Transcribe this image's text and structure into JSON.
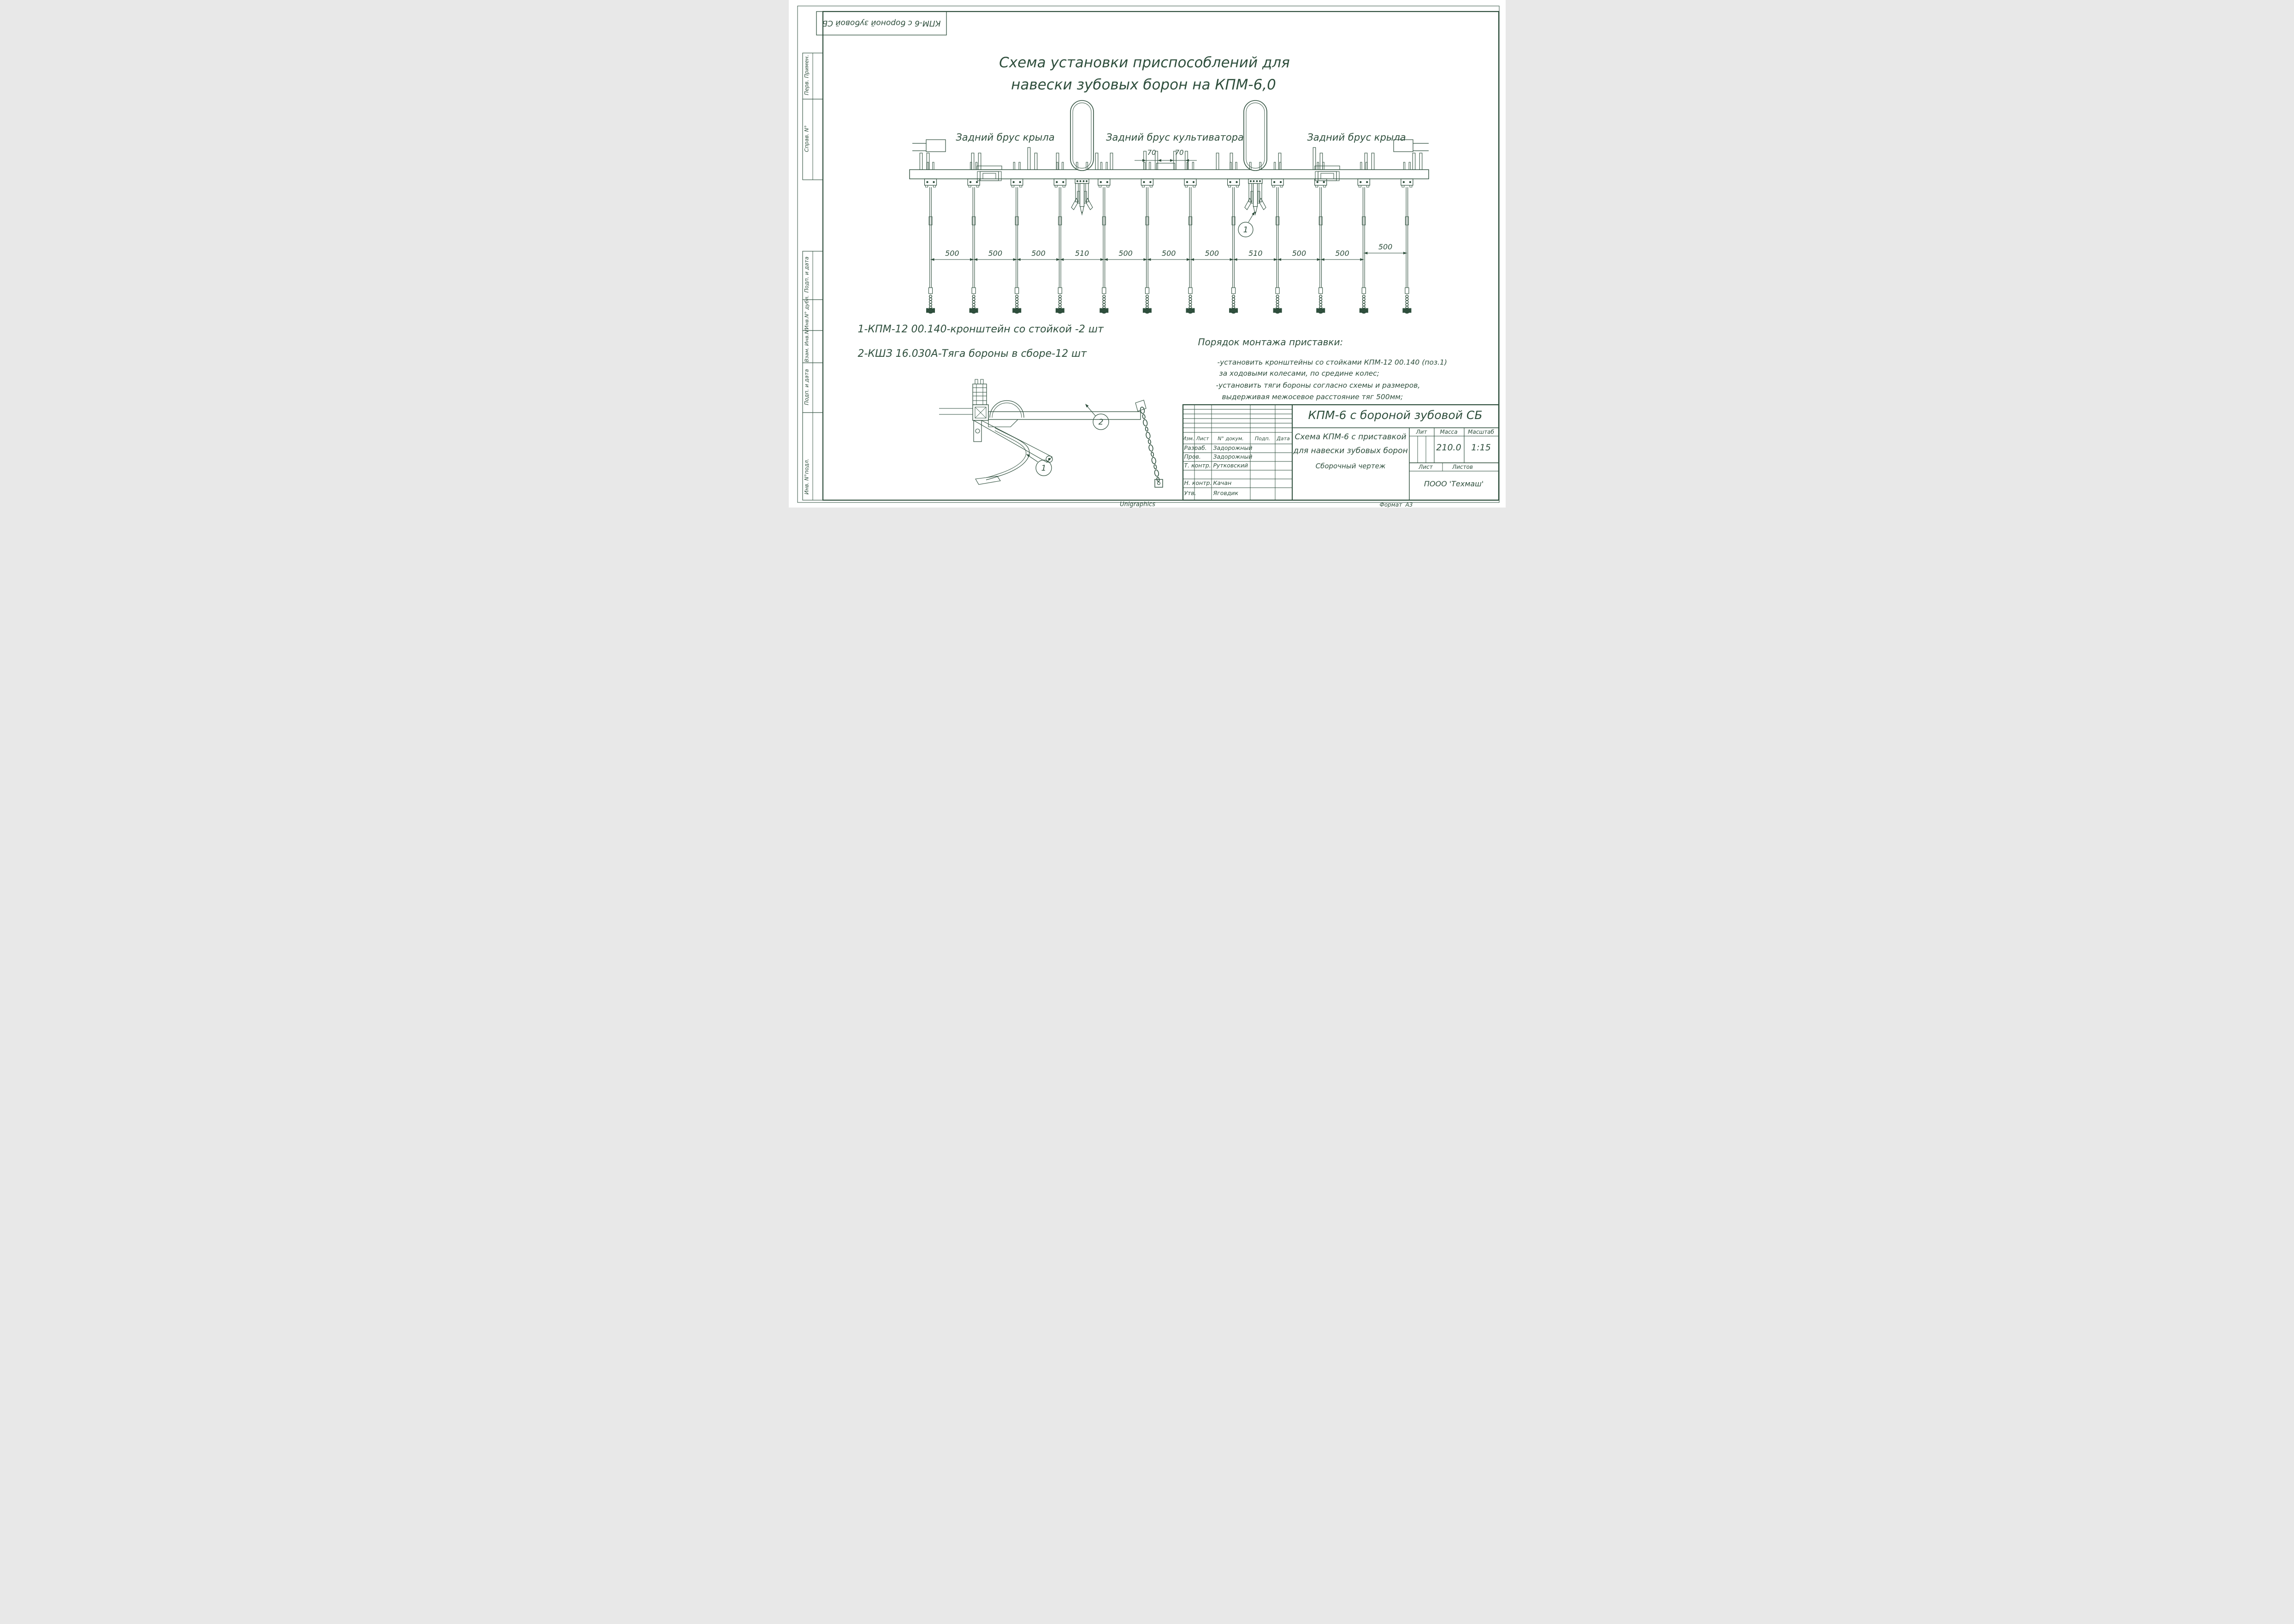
{
  "colors": {
    "ink": "#2e4e3c",
    "paper": "#ffffff"
  },
  "stamp": {
    "top_title": "КПМ-6 с бороной зубовой СБ"
  },
  "margin_labels": [
    "Перв. Примен.",
    "Справ. N°",
    "Подп. и дата",
    "Инв.N° дубл.",
    "Взам. Инв.N°",
    "Подп. и дата",
    "Инв. N°подл."
  ],
  "title": {
    "line1": "Схема установки приспособлений для",
    "line2": "навески зубовых борон на КПМ-6,0"
  },
  "beam_labels": {
    "left": "Задний брус крыла",
    "center": "Задний брус культиватора",
    "right": "Задний брус крыла"
  },
  "dimensions": {
    "spacings": [
      "500",
      "500",
      "500",
      "510",
      "500",
      "500",
      "500",
      "510",
      "500",
      "500",
      "500"
    ],
    "offsets": [
      "70",
      "70"
    ]
  },
  "callouts": {
    "main_view": "1",
    "detail_rod": "2",
    "detail_bracket": "1"
  },
  "notes": [
    "1-КПМ-12 00.140-кронштейн со стойкой -2 шт",
    "2-КШЗ 16.030А-Тяга бороны в сборе-12 шт"
  ],
  "procedure": {
    "title": "Порядок монтажа приставки:",
    "lines": [
      "-установить кронштейны со стойками КПМ-12 00.140 (поз.1)",
      "за ходовыми колесами, по средине колес;",
      "-установить тяги бороны согласно схемы и размеров,",
      "выдерживая межосевое расстояние тяг 500мм;"
    ]
  },
  "titleblock": {
    "doc_title": "КПМ-6 с бороной зубовой СБ",
    "doc_name1": "Схема КПМ-6 с приставкой",
    "doc_name2": "для навески зубовых борон",
    "doc_type": "Сборочный чертеж",
    "headers": {
      "izm": "Изм.",
      "list": "Лист",
      "ndokum": "N° докум.",
      "podp": "Подп.",
      "data": "Дата",
      "lit": "Лит",
      "massa": "Масса",
      "masshtab": "Масштаб",
      "list2": "Лист",
      "listov": "Листов"
    },
    "rows": [
      {
        "role": "Разраб.",
        "name": "Задорожный"
      },
      {
        "role": "Пров.",
        "name": "Задорожный"
      },
      {
        "role": "Т. контр.",
        "name": "Рутковский"
      },
      {
        "role": "Н. контр.",
        "name": "Качан"
      },
      {
        "role": "Утв.",
        "name": "Яговдик"
      }
    ],
    "massa_value": "210.0",
    "masshtab_value": "1:15",
    "company": "ПООО 'Техмаш'"
  },
  "footer": {
    "generator": "Unigraphics",
    "format_label": "Формат",
    "format_value": "А3"
  }
}
